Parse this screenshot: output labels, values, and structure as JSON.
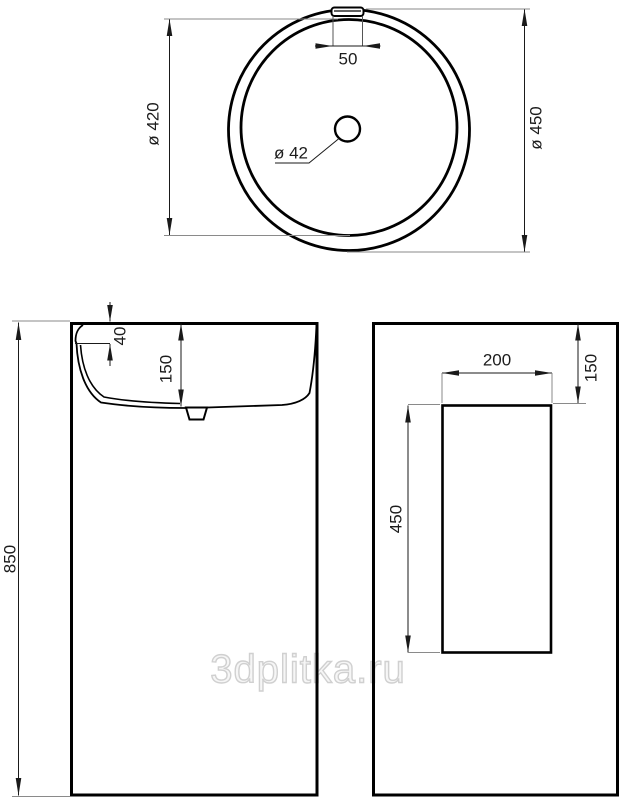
{
  "drawing": {
    "watermark": "3dplitka.ru",
    "colors": {
      "line": "#000000",
      "extension_line": "#8a8a8a",
      "watermark_outline": "#d0d0d0",
      "background": "#ffffff"
    },
    "top_view": {
      "outer_diameter": "ø 450",
      "inner_diameter": "ø 420",
      "overflow_width": "50",
      "drain_diameter": "ø 42"
    },
    "front_view": {
      "total_height": "850",
      "rim_offset": "40",
      "basin_depth": "150"
    },
    "side_view": {
      "recess_width": "200",
      "top_offset": "150",
      "recess_height": "450"
    }
  }
}
